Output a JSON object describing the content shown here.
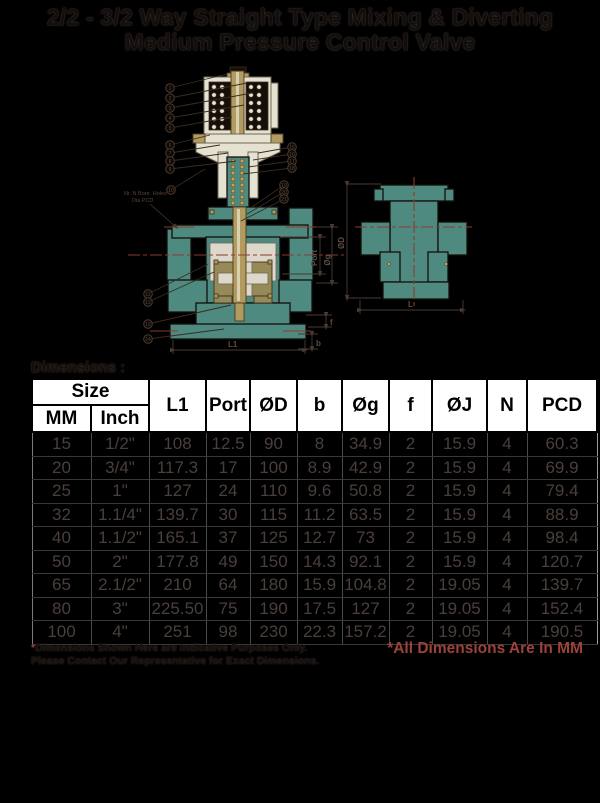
{
  "title": {
    "line1": "2/2 - 3/2 Way Straight Type Mixing & Diverting",
    "line2": "Medium Pressure Control Valve"
  },
  "drawing": {
    "flange_note_line1": "Nr. N Bore. Holes",
    "flange_note_line2": "Dia PCD",
    "dim_labels": {
      "port": "Port",
      "og": "Øg",
      "od": "ØD",
      "l1": "L1",
      "l": "L",
      "f": "f",
      "b": "b"
    },
    "callout_numbers": [
      "1",
      "2",
      "3",
      "4",
      "5",
      "6",
      "7",
      "8",
      "9",
      "10",
      "11",
      "12",
      "13",
      "14",
      "15",
      "16",
      "17",
      "18",
      "19",
      "20",
      "21"
    ],
    "colors": {
      "body_teal": "#4f8a81",
      "brass": "#b19b61",
      "housing_cream": "#e6e2d2",
      "centerline_red": "#8e3c2b"
    }
  },
  "dimensions_label": "Dimensions :",
  "table": {
    "header": {
      "size": "Size",
      "mm": "MM",
      "inch": "Inch",
      "l1": "L1",
      "port": "Port",
      "od": "ØD",
      "b": "b",
      "og": "Øg",
      "f": "f",
      "oj": "ØJ",
      "n": "N",
      "pcd": "PCD"
    },
    "rows": [
      [
        "15",
        "1/2\"",
        "108",
        "12.5",
        "90",
        "8",
        "34.9",
        "2",
        "15.9",
        "4",
        "60.3"
      ],
      [
        "20",
        "3/4\"",
        "117.3",
        "17",
        "100",
        "8.9",
        "42.9",
        "2",
        "15.9",
        "4",
        "69.9"
      ],
      [
        "25",
        "1\"",
        "127",
        "24",
        "110",
        "9.6",
        "50.8",
        "2",
        "15.9",
        "4",
        "79.4"
      ],
      [
        "32",
        "1.1/4\"",
        "139.7",
        "30",
        "115",
        "11.2",
        "63.5",
        "2",
        "15.9",
        "4",
        "88.9"
      ],
      [
        "40",
        "1.1/2\"",
        "165.1",
        "37",
        "125",
        "12.7",
        "73",
        "2",
        "15.9",
        "4",
        "98.4"
      ],
      [
        "50",
        "2\"",
        "177.8",
        "49",
        "150",
        "14.3",
        "92.1",
        "2",
        "15.9",
        "4",
        "120.7"
      ],
      [
        "65",
        "2.1/2\"",
        "210",
        "64",
        "180",
        "15.9",
        "104.8",
        "2",
        "19.05",
        "4",
        "139.7"
      ],
      [
        "80",
        "3\"",
        "225.50",
        "75",
        "190",
        "17.5",
        "127",
        "2",
        "19.05",
        "4",
        "152.4"
      ],
      [
        "100",
        "4\"",
        "251",
        "98",
        "230",
        "22.3",
        "157.2",
        "2",
        "19.05",
        "4",
        "190.5"
      ]
    ]
  },
  "footnotes": {
    "left_star": "*",
    "left_line1": "Dimensions Shown Here are Indicative Purposes Only.",
    "left_line2": "Please Contact Our Representative for Exact Dimensions.",
    "right": "*All Dimensions Are In MM"
  }
}
